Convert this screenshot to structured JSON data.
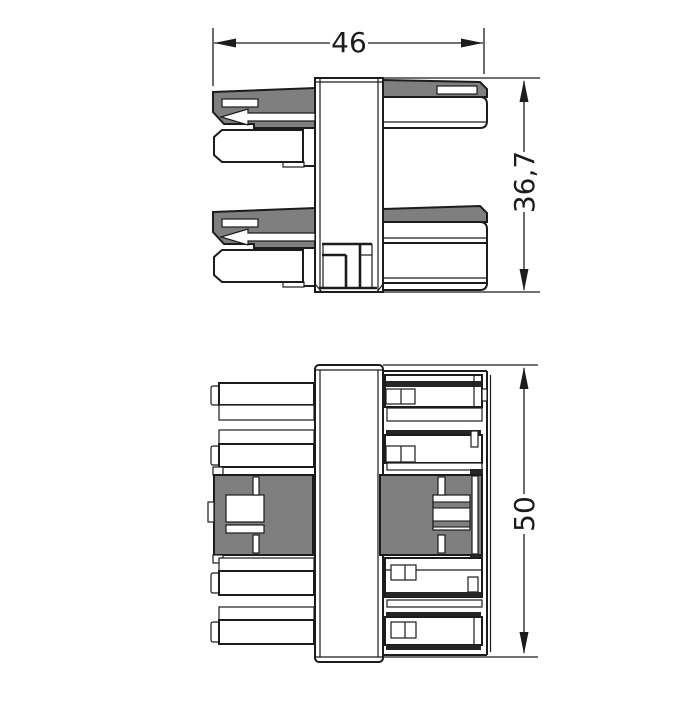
{
  "drawing": {
    "dimensions": {
      "width_mm": "46",
      "depth_mm": "36,7",
      "height_mm": "50"
    },
    "colors": {
      "line": "#1c1c1c",
      "part_gray": "#7f7f7f",
      "contact_dark": "#262626",
      "background": "#ffffff"
    }
  }
}
